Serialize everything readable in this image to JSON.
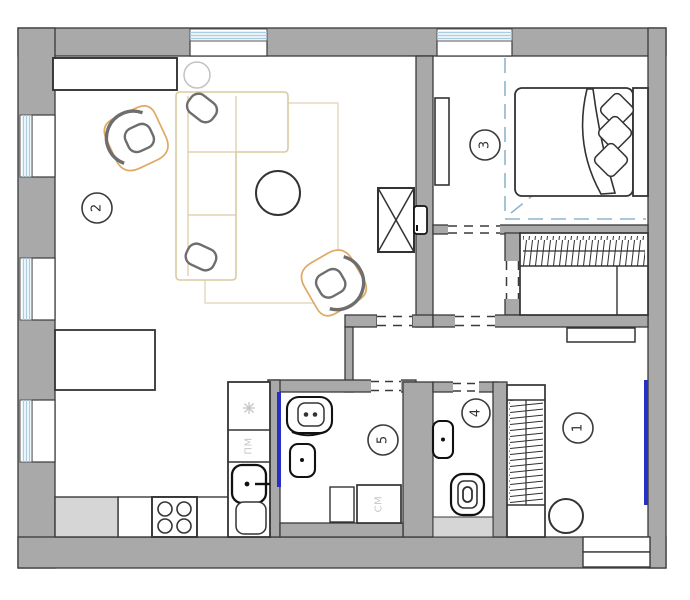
{
  "room_labels": {
    "r1": "1",
    "r2": "2",
    "r3": "3",
    "r4": "4",
    "r5": "5"
  },
  "appliance_labels": {
    "dishwasher": "ПМ",
    "washing_machine": "СМ"
  },
  "colors": {
    "wall_fill": "#a9a9a9",
    "wall_outline": "#3a3a3a",
    "furniture_outline": "#333333",
    "sofa_outline": "#d9cba1",
    "rug_outline": "#e4dbbf",
    "armchair_accent": "#dfa963",
    "pillow_gray": "#6e6e6e",
    "window_glazing_blue": "#a9cde2",
    "partition_dash_blue": "#8fb6ce",
    "accent_blue": "#2730c4",
    "light_gray_fill": "#d6d6d6",
    "label_light_gray": "#c6c6c6"
  }
}
